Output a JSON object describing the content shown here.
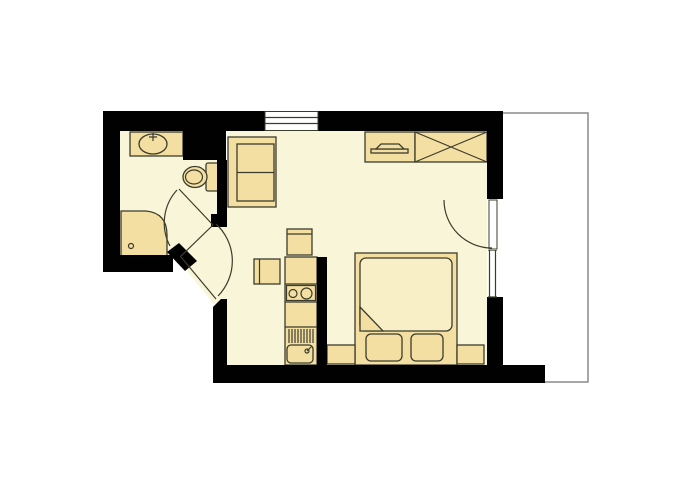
{
  "title": "studio-apartment-floor-plan",
  "colors": {
    "background": "#ffffff",
    "wall": "#010101",
    "floor": "#f9f5d8",
    "furniture": "#f3dfa2",
    "furniture_light": "#f8efc6",
    "outline": "#3c3c2c",
    "balcony_line": "#8a8a8a"
  },
  "rooms": [
    {
      "name": "bathroom"
    },
    {
      "name": "entry-hall"
    },
    {
      "name": "main-room"
    },
    {
      "name": "kitchenette"
    },
    {
      "name": "balcony"
    }
  ],
  "fixtures": [
    {
      "name": "washbasin"
    },
    {
      "name": "toilet"
    },
    {
      "name": "corner-shower"
    },
    {
      "name": "sofa",
      "seats": 2
    },
    {
      "name": "tv-dresser"
    },
    {
      "name": "wardrobe"
    },
    {
      "name": "fridge-unit"
    },
    {
      "name": "side-table"
    },
    {
      "name": "kitchen-counter"
    },
    {
      "name": "stove",
      "burners": 2
    },
    {
      "name": "kitchen-sink"
    },
    {
      "name": "double-bed"
    },
    {
      "name": "pillow",
      "count": 2
    },
    {
      "name": "nightstand",
      "count": 2
    }
  ],
  "doors": [
    {
      "name": "bathroom-door"
    },
    {
      "name": "hall-door"
    },
    {
      "name": "entrance-door"
    }
  ],
  "windows": [
    {
      "name": "top-window"
    },
    {
      "name": "right-window"
    }
  ]
}
